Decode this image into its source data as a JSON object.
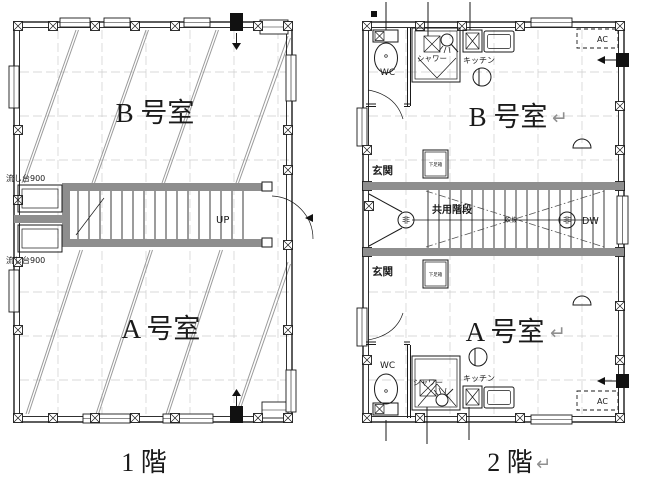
{
  "colors": {
    "line": "#1a1a1a",
    "stair_wall_gray": "#8e8e8e",
    "grid_gray": "#cdcdcd",
    "return_mark_gray": "#8f8f8f"
  },
  "floor1": {
    "caption": "1 階",
    "room_b_label": "B 号室",
    "room_a_label": "A 号室",
    "sink_label_top": "流し台900",
    "sink_label_bottom": "流し台900",
    "up_label": "UP"
  },
  "floor2": {
    "caption": "2 階",
    "caption_return": "↵",
    "room_b_label": "B 号室",
    "room_b_return": "↵",
    "room_a_label": "A 号室",
    "room_a_return": "↵",
    "wc_label_top": "WC",
    "wc_label_bottom": "WC",
    "shower_label_top": "シャワー",
    "shower_label_bottom": "シャワー",
    "kitchen_label_top": "キッチン",
    "kitchen_label_bottom": "キッチン",
    "ac_label_top": "AC",
    "ac_label_bottom": "AC",
    "entrance_label_top": "玄関",
    "entrance_label_bottom": "玄関",
    "shoebox_label_top": "下足箱",
    "shoebox_label_bottom": "下足箱",
    "shared_stairs_label": "共用階段",
    "stair_center_label": "吹抜",
    "emergency_label_left": "非",
    "emergency_label_right": "非",
    "dw_label": "DW"
  }
}
